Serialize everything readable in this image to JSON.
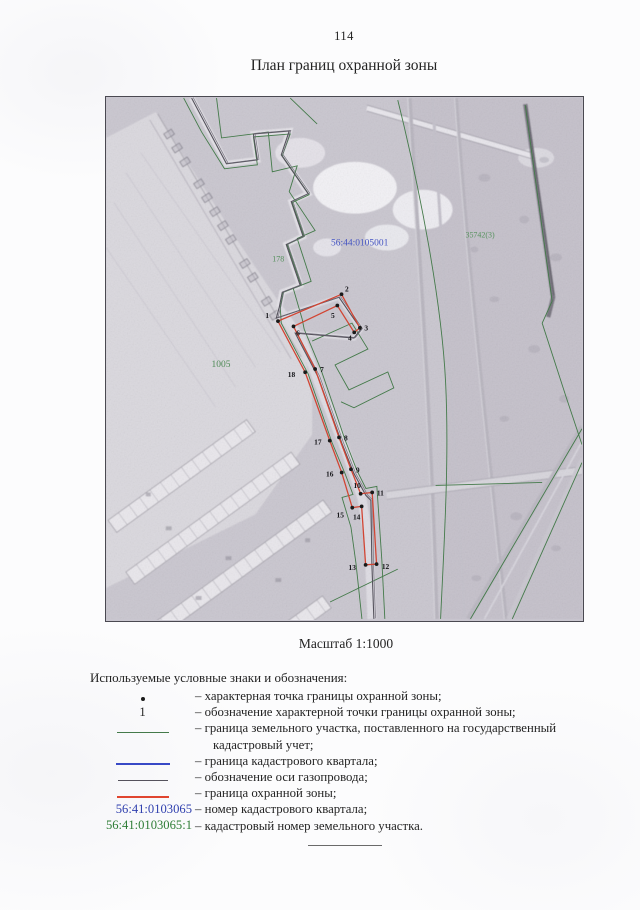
{
  "page": {
    "number": "114",
    "title": "План границ охранной зоны",
    "scale_label": "Масштаб 1:1000"
  },
  "map": {
    "labels": {
      "cadastral_quarter_blue": "56:44:0105001",
      "parcel_green_right": "35742(3)",
      "parcel_green_corridor": "178",
      "parcel_green_field": "1005"
    },
    "points": [
      {
        "n": "1",
        "x": 172.7,
        "y": 224,
        "lx": 160,
        "ly": 221
      },
      {
        "n": "2",
        "x": 236.5,
        "y": 197,
        "lx": 240,
        "ly": 194
      },
      {
        "n": "3",
        "x": 255,
        "y": 230.7,
        "lx": 259.5,
        "ly": 233.5
      },
      {
        "n": "4",
        "x": 249.3,
        "y": 235.3,
        "lx": 243,
        "ly": 243.5
      },
      {
        "n": "5",
        "x": 232.3,
        "y": 208.3,
        "lx": 226,
        "ly": 221
      },
      {
        "n": "6",
        "x": 188.3,
        "y": 229.3,
        "lx": 191,
        "ly": 238.5
      },
      {
        "n": "7",
        "x": 210,
        "y": 272,
        "lx": 215,
        "ly": 275
      },
      {
        "n": "8",
        "x": 234,
        "y": 340.7,
        "lx": 239,
        "ly": 344
      },
      {
        "n": "9",
        "x": 246,
        "y": 372.7,
        "lx": 251,
        "ly": 376
      },
      {
        "n": "10",
        "x": 255.7,
        "y": 397.3,
        "lx": 248.5,
        "ly": 391.5
      },
      {
        "n": "11",
        "x": 267.3,
        "y": 396,
        "lx": 272,
        "ly": 399
      },
      {
        "n": "12",
        "x": 271.7,
        "y": 468,
        "lx": 277,
        "ly": 473
      },
      {
        "n": "13",
        "x": 260.7,
        "y": 468.7,
        "lx": 243.5,
        "ly": 474
      },
      {
        "n": "14",
        "x": 256.7,
        "y": 410,
        "lx": 248,
        "ly": 423
      },
      {
        "n": "15",
        "x": 247.3,
        "y": 411.3,
        "lx": 231.5,
        "ly": 421
      },
      {
        "n": "16",
        "x": 236.7,
        "y": 376,
        "lx": 221,
        "ly": 380
      },
      {
        "n": "17",
        "x": 224.7,
        "y": 344,
        "lx": 209,
        "ly": 348
      },
      {
        "n": "18",
        "x": 200,
        "y": 275.3,
        "lx": 182.5,
        "ly": 280
      }
    ]
  },
  "legend": {
    "heading": "Используемые условные знаки и обозначения:",
    "items": [
      {
        "type": "point-dot",
        "symbol": "•",
        "text": "– характерная точка границы охранной зоны;"
      },
      {
        "type": "point-number",
        "symbol": "1",
        "text": "– обозначение характерной точки границы охранной зоны;"
      },
      {
        "type": "line-green",
        "symbol": "green-line",
        "text": "– граница земельного участка, поставленного на государственный кадастровый учет;"
      },
      {
        "type": "line-blue",
        "symbol": "blue-line",
        "text": "– граница кадастрового квартала;"
      },
      {
        "type": "line-gray",
        "symbol": "gray-line",
        "text": "– обозначение оси газопровода;"
      },
      {
        "type": "line-red",
        "symbol": "red-line",
        "text": "– граница охранной зоны;"
      },
      {
        "type": "number-blue",
        "symbol": "56:41:0103065",
        "text": "– номер кадастрового квартала;"
      },
      {
        "type": "number-green",
        "symbol": "56:41:0103065:1",
        "text": "– кадастровый номер земельного участка."
      }
    ]
  },
  "colors": {
    "protected_zone_red": "#d24533",
    "parcel_green": "#447a4a",
    "quarter_blue": "#3849c6",
    "pipeline_axis_gray": "#55525c",
    "number_blue": "#2f3fae",
    "number_green": "#2e7d36",
    "point_black": "#1a1a1a"
  }
}
